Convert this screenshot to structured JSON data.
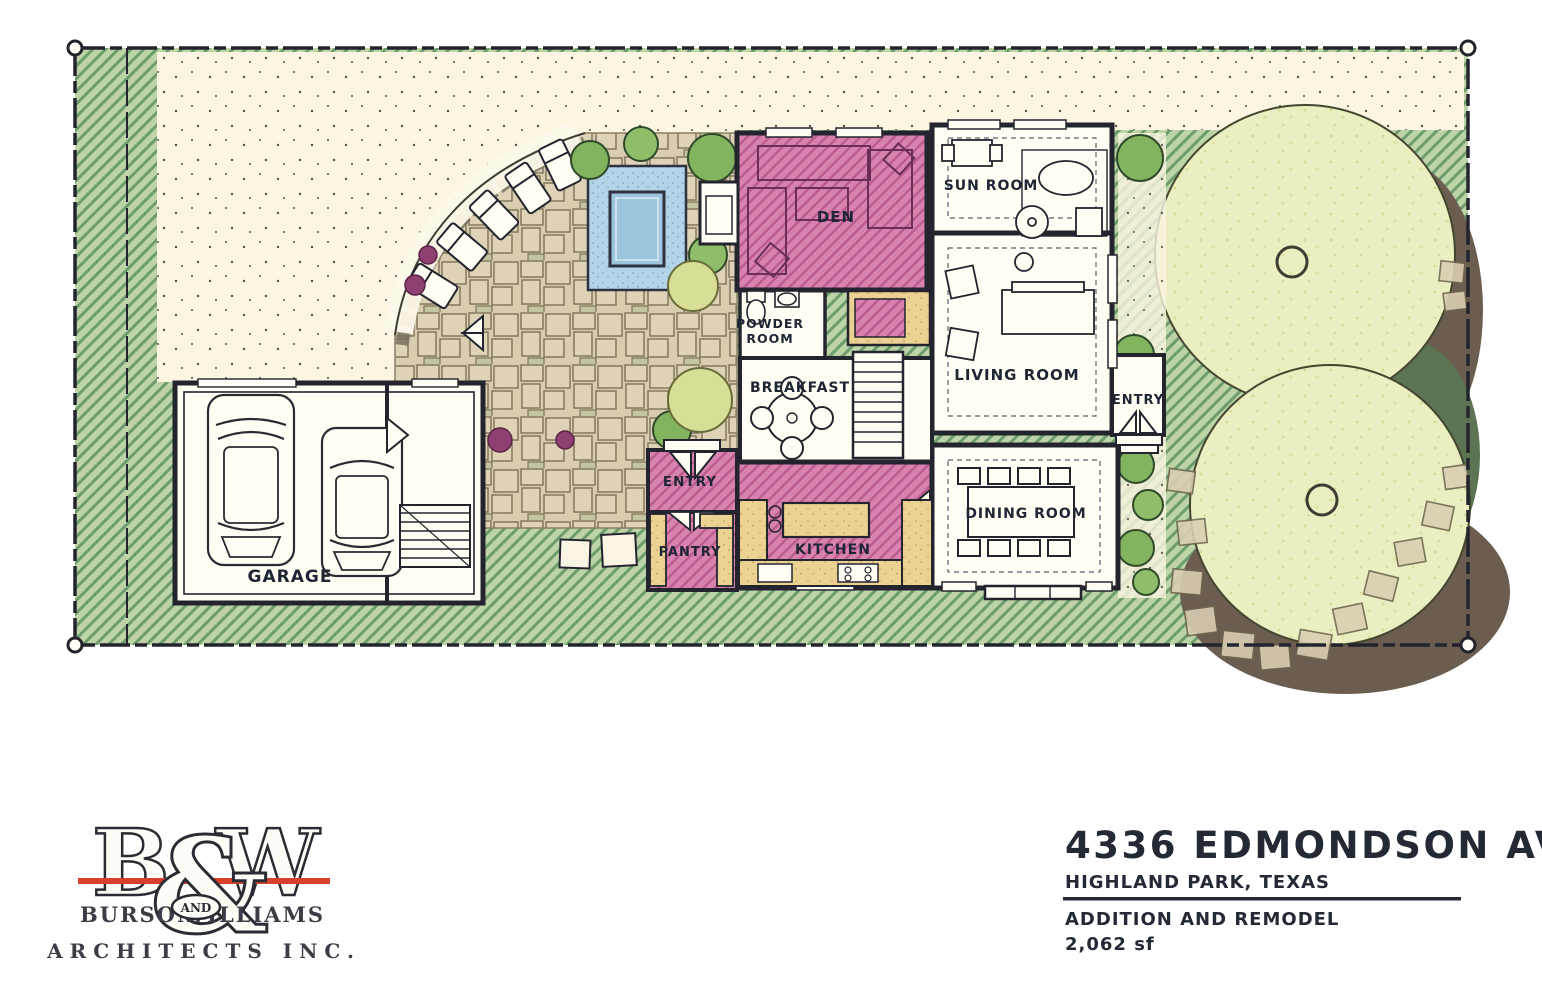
{
  "rooms": {
    "den": "DEN",
    "sun_room": "SUN ROOM",
    "powder_line1": "POWDER",
    "powder_line2": "ROOM",
    "breakfast": "BREAKFAST",
    "living_room": "LIVING ROOM",
    "entry_side": "ENTRY",
    "entry_rear": "ENTRY",
    "pantry": "PANTRY",
    "kitchen": "KITCHEN",
    "dining_room": "DINING ROOM",
    "garage": "GARAGE"
  },
  "title_block": {
    "address": "4336 EDMONDSON AVE.",
    "city": "HIGHLAND PARK, TEXAS",
    "project": "ADDITION AND REMODEL",
    "area": "2,062 sf"
  },
  "logo": {
    "b": "B",
    "amp": "&",
    "w": "W",
    "burson": "BURSON",
    "and": "AND",
    "williams": "WILLIAMS",
    "architects": "ARCHITECTS INC."
  },
  "colors": {
    "lawn": "#bdd5a6",
    "lawn_hatch": "#6e9c6e",
    "remodel_pink": "#d783ad",
    "pink_hatch": "#bb5b90",
    "cream": "#fbf5e1",
    "flagstone": "#d8cdae",
    "water": "#b3d4e6",
    "counter_tan": "#ecd292",
    "tree_canopy": "#ebeec1",
    "tree_shadow": "#6b5e50",
    "shadow_green": "#5c7452",
    "wall": "#23242e",
    "logo_red": "#d8402e",
    "text": "#232a36"
  }
}
